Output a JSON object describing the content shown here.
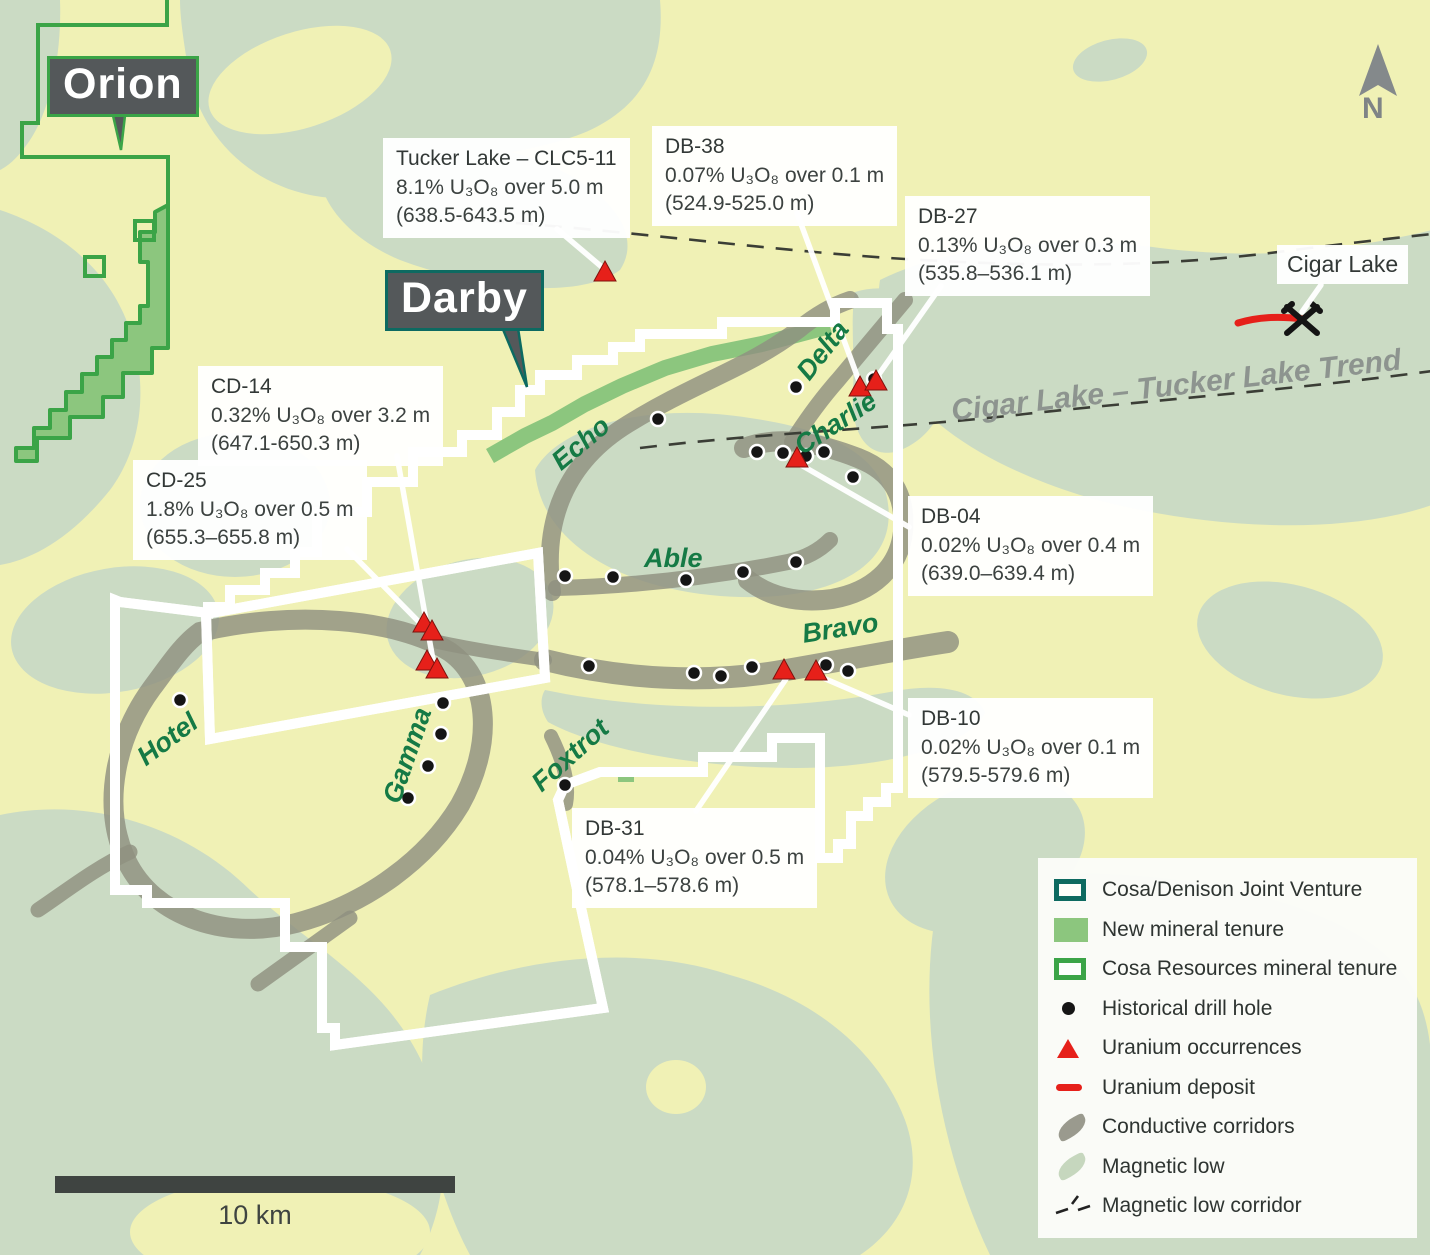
{
  "projects": {
    "orion": "Orion",
    "darby": "Darby"
  },
  "annotations": [
    {
      "id": "tucker-lake",
      "title": "Tucker Lake – CLC5-11",
      "grade": "8.1% U₃O₈ over 5.0 m",
      "interval": "(638.5-643.5 m)"
    },
    {
      "id": "db-38",
      "title": "DB-38",
      "grade": "0.07% U₃O₈ over 0.1 m",
      "interval": "(524.9-525.0 m)"
    },
    {
      "id": "db-27",
      "title": "DB-27",
      "grade": "0.13% U₃O₈ over 0.3 m",
      "interval": "(535.8–536.1 m)"
    },
    {
      "id": "cd-14",
      "title": "CD-14",
      "grade": "0.32% U₃O₈ over 3.2 m",
      "interval": "(647.1-650.3 m)"
    },
    {
      "id": "cd-25",
      "title": "CD-25",
      "grade": "1.8% U₃O₈ over 0.5 m",
      "interval": "(655.3–655.8 m)"
    },
    {
      "id": "db-04",
      "title": "DB-04",
      "grade": "0.02% U₃O₈ over 0.4 m",
      "interval": "(639.0–639.4 m)"
    },
    {
      "id": "db-10",
      "title": "DB-10",
      "grade": "0.02% U₃O₈ over 0.1 m",
      "interval": "(579.5-579.6 m)"
    },
    {
      "id": "db-31",
      "title": "DB-31",
      "grade": "0.04% U₃O₈ over 0.5 m",
      "interval": "(578.1–578.6 m)"
    }
  ],
  "cigar_lake_label": "Cigar Lake",
  "trend_label": "Cigar Lake – Tucker Lake Trend",
  "zones": [
    "Delta",
    "Charlie",
    "Echo",
    "Able",
    "Bravo",
    "Hotel",
    "Gamma",
    "Foxtrot"
  ],
  "north_label": "N",
  "scale_label": "10 km",
  "legend": {
    "items": [
      {
        "icon": "jv-boundary-swatch",
        "label": "Cosa/Denison Joint Venture"
      },
      {
        "icon": "new-tenure-swatch",
        "label": "New mineral tenure"
      },
      {
        "icon": "cosa-tenure-swatch",
        "label": "Cosa Resources mineral tenure"
      },
      {
        "icon": "drill-hole-dot",
        "label": "Historical drill hole"
      },
      {
        "icon": "uranium-triangle",
        "label": "Uranium occurrences"
      },
      {
        "icon": "uranium-deposit-line",
        "label": "Uranium deposit"
      },
      {
        "icon": "conductive-corridor-blob",
        "label": "Conductive corridors"
      },
      {
        "icon": "magnetic-low-blob",
        "label": "Magnetic low"
      },
      {
        "icon": "magnetic-low-corridor-dash",
        "label": "Magnetic low corridor"
      }
    ]
  },
  "colors": {
    "joint_venture_teal": "#0d6a61",
    "cosa_tenure_green": "#3ba447",
    "new_tenure_green": "#8cc67e",
    "uranium_red": "#e6201a",
    "corridor_gray": "#8f9080",
    "magnetic_low_sage": "#cbdbc4",
    "base_yellow": "#f0f1b5",
    "label_box_dark": "#54585a"
  }
}
